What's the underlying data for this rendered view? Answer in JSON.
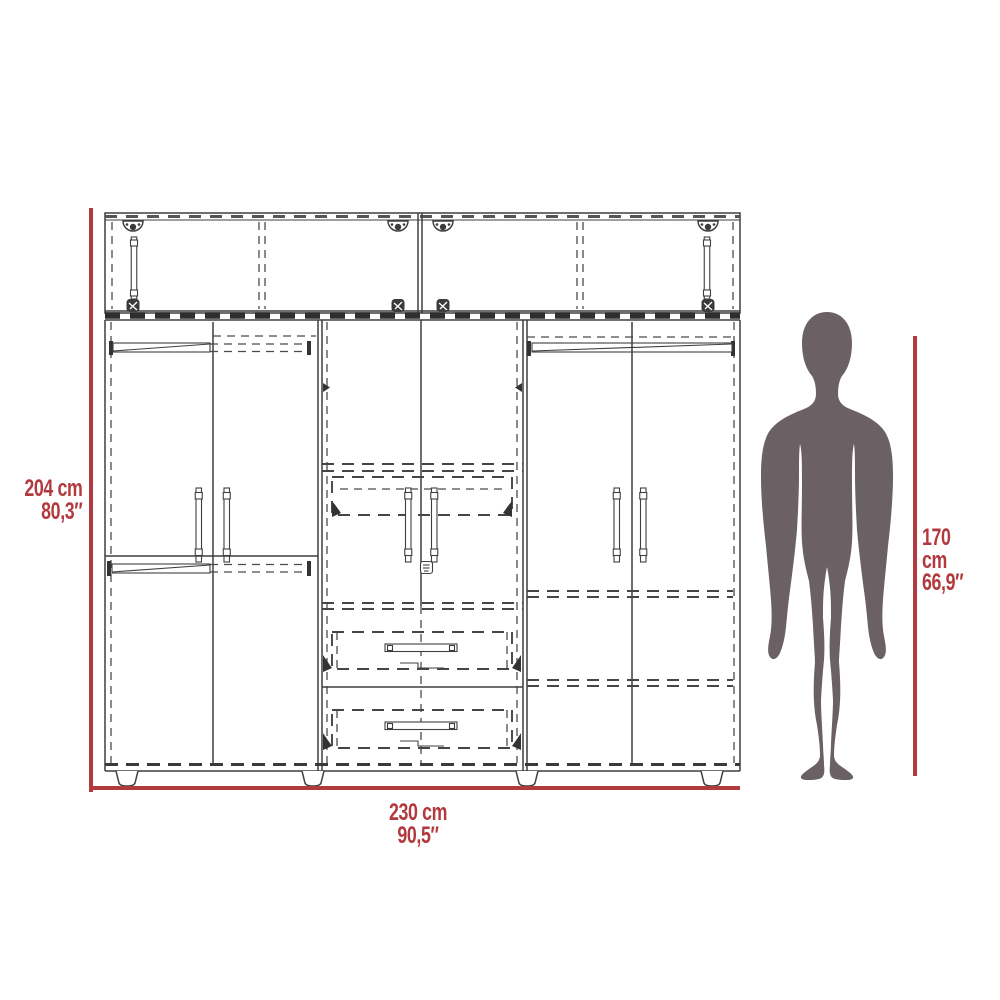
{
  "title": "wardrobe-dimensions-diagram",
  "colors": {
    "accent_red": "#b23a3e",
    "silhouette": "#6b6165",
    "drawing_line": "#3f3f3f",
    "background": "#ffffff"
  },
  "dimensions": {
    "wardrobe_height": {
      "cm": "204 cm",
      "inches": "80,3″"
    },
    "wardrobe_width": {
      "cm": "230 cm",
      "inches": "90,5″"
    },
    "person_height": {
      "cm": "170 cm",
      "inches": "66,9″"
    }
  }
}
